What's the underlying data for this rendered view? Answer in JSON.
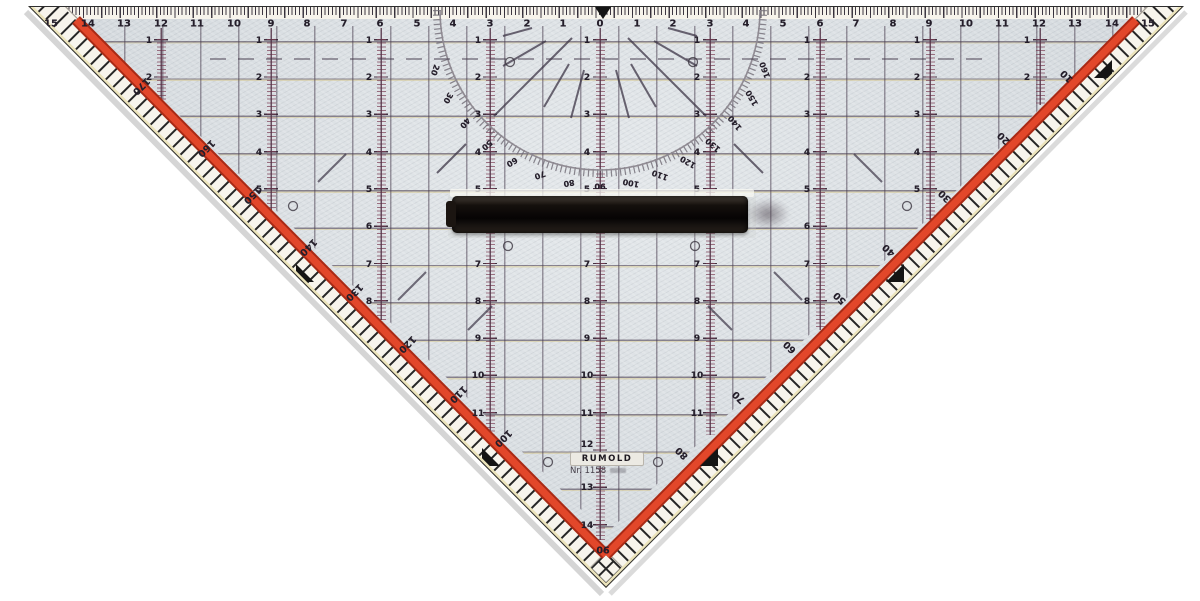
{
  "product": {
    "brand": "RUMOLD",
    "model": "Nr. 1158"
  },
  "colors": {
    "plastic": "#d8dde1",
    "red_stripe": "#d8371f",
    "grid_ink": "#4a4550",
    "handle": "#0d0a08"
  },
  "top_scale": {
    "unit_labels": [
      {
        "t": "15",
        "x": 51
      },
      {
        "t": "14",
        "x": 88
      },
      {
        "t": "13",
        "x": 124
      },
      {
        "t": "12",
        "x": 161
      },
      {
        "t": "11",
        "x": 197
      },
      {
        "t": "10",
        "x": 234
      },
      {
        "t": "9",
        "x": 271
      },
      {
        "t": "8",
        "x": 307
      },
      {
        "t": "7",
        "x": 344
      },
      {
        "t": "6",
        "x": 380
      },
      {
        "t": "5",
        "x": 417
      },
      {
        "t": "4",
        "x": 453
      },
      {
        "t": "3",
        "x": 490
      },
      {
        "t": "2",
        "x": 527
      },
      {
        "t": "1",
        "x": 563
      },
      {
        "t": "0",
        "x": 600
      },
      {
        "t": "1",
        "x": 637
      },
      {
        "t": "2",
        "x": 673
      },
      {
        "t": "3",
        "x": 710
      },
      {
        "t": "4",
        "x": 746
      },
      {
        "t": "5",
        "x": 783
      },
      {
        "t": "6",
        "x": 820
      },
      {
        "t": "7",
        "x": 856
      },
      {
        "t": "8",
        "x": 893
      },
      {
        "t": "9",
        "x": 929
      },
      {
        "t": "10",
        "x": 966
      },
      {
        "t": "11",
        "x": 1002
      },
      {
        "t": "12",
        "x": 1039
      },
      {
        "t": "13",
        "x": 1075
      },
      {
        "t": "14",
        "x": 1112
      },
      {
        "t": "15",
        "x": 1148
      }
    ]
  },
  "grid": {
    "row_labels": [
      {
        "t": "1",
        "x": 149,
        "y": 41
      },
      {
        "t": "2",
        "x": 149,
        "y": 78
      },
      {
        "t": "1",
        "x": 259,
        "y": 41
      },
      {
        "t": "2",
        "x": 259,
        "y": 78
      },
      {
        "t": "3",
        "x": 259,
        "y": 115
      },
      {
        "t": "4",
        "x": 259,
        "y": 153
      },
      {
        "t": "5",
        "x": 259,
        "y": 190
      },
      {
        "t": "1",
        "x": 369,
        "y": 41
      },
      {
        "t": "2",
        "x": 369,
        "y": 78
      },
      {
        "t": "3",
        "x": 369,
        "y": 115
      },
      {
        "t": "4",
        "x": 369,
        "y": 153
      },
      {
        "t": "5",
        "x": 369,
        "y": 190
      },
      {
        "t": "6",
        "x": 369,
        "y": 227
      },
      {
        "t": "7",
        "x": 369,
        "y": 265
      },
      {
        "t": "8",
        "x": 369,
        "y": 302
      },
      {
        "t": "1",
        "x": 478,
        "y": 41
      },
      {
        "t": "2",
        "x": 478,
        "y": 78
      },
      {
        "t": "3",
        "x": 478,
        "y": 115
      },
      {
        "t": "4",
        "x": 478,
        "y": 153
      },
      {
        "t": "5",
        "x": 478,
        "y": 190
      },
      {
        "t": "6",
        "x": 478,
        "y": 227
      },
      {
        "t": "7",
        "x": 478,
        "y": 265
      },
      {
        "t": "8",
        "x": 478,
        "y": 302
      },
      {
        "t": "9",
        "x": 478,
        "y": 339
      },
      {
        "t": "10",
        "x": 478,
        "y": 376
      },
      {
        "t": "11",
        "x": 478,
        "y": 414
      },
      {
        "t": "1",
        "x": 587,
        "y": 41
      },
      {
        "t": "2",
        "x": 587,
        "y": 78
      },
      {
        "t": "3",
        "x": 587,
        "y": 115
      },
      {
        "t": "4",
        "x": 587,
        "y": 153
      },
      {
        "t": "5",
        "x": 587,
        "y": 190
      },
      {
        "t": "6",
        "x": 587,
        "y": 227
      },
      {
        "t": "7",
        "x": 587,
        "y": 265
      },
      {
        "t": "8",
        "x": 587,
        "y": 302
      },
      {
        "t": "9",
        "x": 587,
        "y": 339
      },
      {
        "t": "10",
        "x": 587,
        "y": 376
      },
      {
        "t": "11",
        "x": 587,
        "y": 414
      },
      {
        "t": "12",
        "x": 587,
        "y": 445
      },
      {
        "t": "13",
        "x": 587,
        "y": 488
      },
      {
        "t": "14",
        "x": 587,
        "y": 526
      },
      {
        "t": "1",
        "x": 697,
        "y": 41
      },
      {
        "t": "2",
        "x": 697,
        "y": 78
      },
      {
        "t": "3",
        "x": 697,
        "y": 115
      },
      {
        "t": "4",
        "x": 697,
        "y": 153
      },
      {
        "t": "5",
        "x": 697,
        "y": 190
      },
      {
        "t": "6",
        "x": 697,
        "y": 227
      },
      {
        "t": "7",
        "x": 697,
        "y": 265
      },
      {
        "t": "8",
        "x": 697,
        "y": 302
      },
      {
        "t": "9",
        "x": 697,
        "y": 339
      },
      {
        "t": "10",
        "x": 697,
        "y": 376
      },
      {
        "t": "11",
        "x": 697,
        "y": 414
      },
      {
        "t": "1",
        "x": 807,
        "y": 41
      },
      {
        "t": "2",
        "x": 807,
        "y": 78
      },
      {
        "t": "3",
        "x": 807,
        "y": 115
      },
      {
        "t": "4",
        "x": 807,
        "y": 153
      },
      {
        "t": "5",
        "x": 807,
        "y": 190
      },
      {
        "t": "6",
        "x": 807,
        "y": 227
      },
      {
        "t": "7",
        "x": 807,
        "y": 265
      },
      {
        "t": "8",
        "x": 807,
        "y": 302
      },
      {
        "t": "1",
        "x": 917,
        "y": 41
      },
      {
        "t": "2",
        "x": 917,
        "y": 78
      },
      {
        "t": "3",
        "x": 917,
        "y": 115
      },
      {
        "t": "4",
        "x": 917,
        "y": 153
      },
      {
        "t": "5",
        "x": 917,
        "y": 190
      },
      {
        "t": "1",
        "x": 1027,
        "y": 41
      },
      {
        "t": "2",
        "x": 1027,
        "y": 78
      }
    ]
  },
  "protractor": {
    "arc_labels": [
      {
        "t": "20",
        "x": 435,
        "y": 70,
        "rot": 110
      },
      {
        "t": "30",
        "x": 448,
        "y": 98,
        "rot": 120
      },
      {
        "t": "40",
        "x": 465,
        "y": 123,
        "rot": 130
      },
      {
        "t": "50",
        "x": 487,
        "y": 145,
        "rot": 140
      },
      {
        "t": "60",
        "x": 512,
        "y": 162,
        "rot": 150
      },
      {
        "t": "70",
        "x": 540,
        "y": 175,
        "rot": 160
      },
      {
        "t": "80",
        "x": 569,
        "y": 183,
        "rot": 170
      },
      {
        "t": "90",
        "x": 600,
        "y": 186,
        "rot": 180
      },
      {
        "t": "100",
        "x": 631,
        "y": 183,
        "rot": 190
      },
      {
        "t": "110",
        "x": 660,
        "y": 175,
        "rot": 200
      },
      {
        "t": "120",
        "x": 688,
        "y": 162,
        "rot": 210
      },
      {
        "t": "130",
        "x": 713,
        "y": 145,
        "rot": 220
      },
      {
        "t": "140",
        "x": 735,
        "y": 123,
        "rot": 230
      },
      {
        "t": "150",
        "x": 752,
        "y": 98,
        "rot": 240
      },
      {
        "t": "160",
        "x": 765,
        "y": 70,
        "rot": 250
      }
    ]
  },
  "edges": {
    "left_degrees": [
      {
        "t": "170",
        "x": 141,
        "y": 86,
        "rot": 135
      },
      {
        "t": "160",
        "x": 206,
        "y": 148,
        "rot": 135
      },
      {
        "t": "150",
        "x": 252,
        "y": 195,
        "rot": 135
      },
      {
        "t": "140",
        "x": 308,
        "y": 247,
        "rot": 135
      },
      {
        "t": "130",
        "x": 354,
        "y": 292,
        "rot": 135
      },
      {
        "t": "120",
        "x": 407,
        "y": 344,
        "rot": 135
      },
      {
        "t": "110",
        "x": 458,
        "y": 394,
        "rot": 135
      },
      {
        "t": "100",
        "x": 503,
        "y": 438,
        "rot": 135
      }
    ],
    "right_degrees": [
      {
        "t": "10",
        "x": 1067,
        "y": 76,
        "rot": -135
      },
      {
        "t": "20",
        "x": 1004,
        "y": 138,
        "rot": -135
      },
      {
        "t": "30",
        "x": 945,
        "y": 196,
        "rot": -135
      },
      {
        "t": "40",
        "x": 889,
        "y": 250,
        "rot": -135
      },
      {
        "t": "50",
        "x": 840,
        "y": 298,
        "rot": -135
      },
      {
        "t": "60",
        "x": 790,
        "y": 347,
        "rot": -135
      },
      {
        "t": "70",
        "x": 739,
        "y": 397,
        "rot": -135
      },
      {
        "t": "80",
        "x": 682,
        "y": 453,
        "rot": -135
      }
    ],
    "vertex_degree": [
      {
        "t": "90",
        "x": 603,
        "y": 549,
        "rot": 180
      }
    ]
  }
}
